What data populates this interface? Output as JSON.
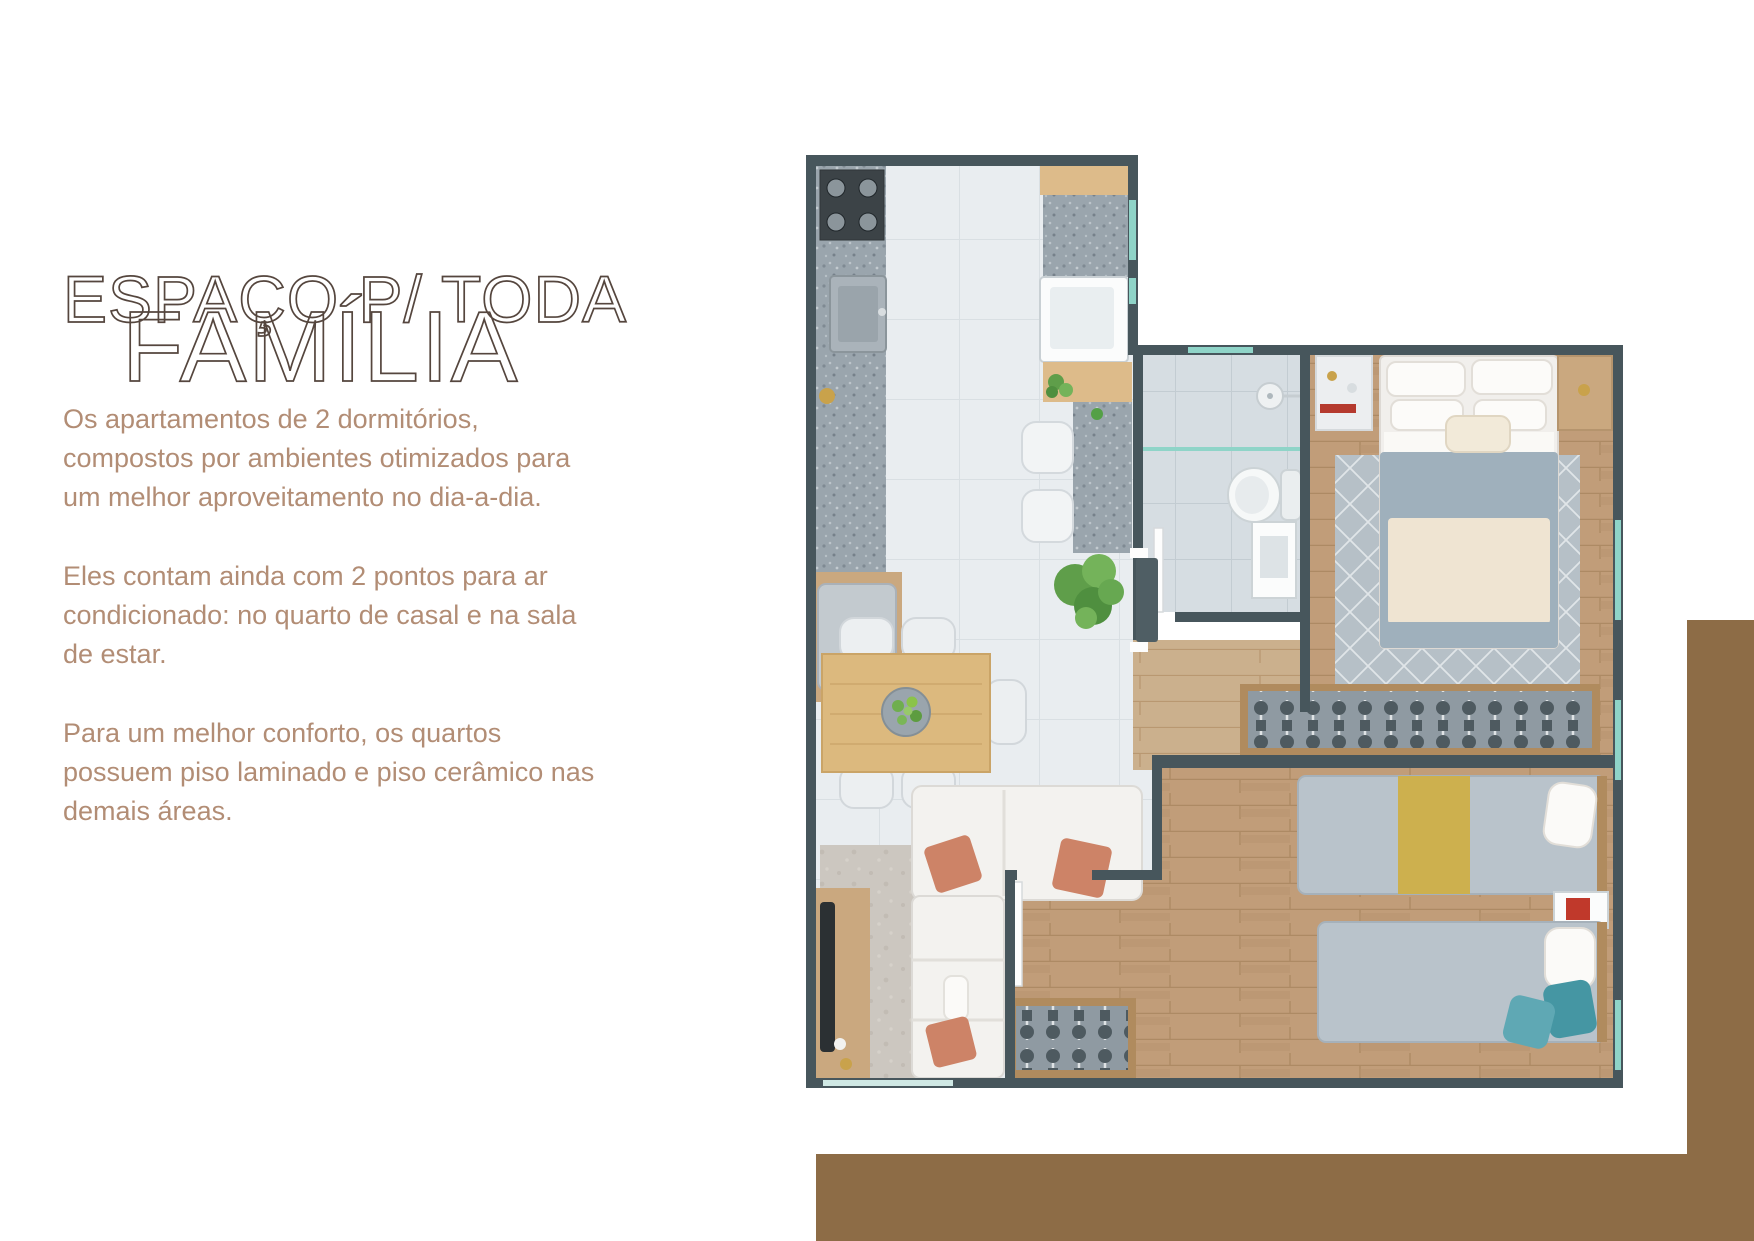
{
  "headline": {
    "line1": "ESPAÇO P/ TODA",
    "line2": "FAMÍLIA"
  },
  "copy": {
    "p1": "Os apartamentos de 2 dormitórios, compostos por ambientes otimizados para um melhor aproveitamento no dia-a-dia.",
    "p2": "Eles contam ainda com 2 pontos para ar condicionado: no quarto de casal e na sala de estar.",
    "p3": "Para um melhor conforto, os quartos possuem piso laminado e piso cerâmico nas demais áreas."
  },
  "theme": {
    "accent": "#8d6c46",
    "text": "#b28d75",
    "outline": "#55463e",
    "wall": "#47565c",
    "tile": "#e9edf0",
    "bath": "#d6dde2",
    "granite": "#9aa5ad",
    "wood": "#c19d79",
    "teal": "#8fd4c8",
    "coral": "#cd8367",
    "duvet": "#9fb0bc",
    "yellow": "#cdb04e",
    "tealpillow": "#4596a3"
  },
  "floor_plan": {
    "type": "apartment-top-view-render",
    "rooms": [
      "kitchen",
      "service-area",
      "dining-area",
      "living-room",
      "hall",
      "bathroom",
      "master-bedroom",
      "second-bedroom"
    ],
    "furniture": [
      "stove",
      "kitchen-sink",
      "fridge",
      "laundry-tank",
      "counter-stools",
      "plants",
      "dining-table-with-chairs",
      "sofa-with-pillows",
      "tv-panel",
      "side-table",
      "toilet",
      "shower",
      "vanity",
      "double-bed",
      "nightstands",
      "wardrobe-racks",
      "two-single-beds",
      "rugs"
    ]
  }
}
